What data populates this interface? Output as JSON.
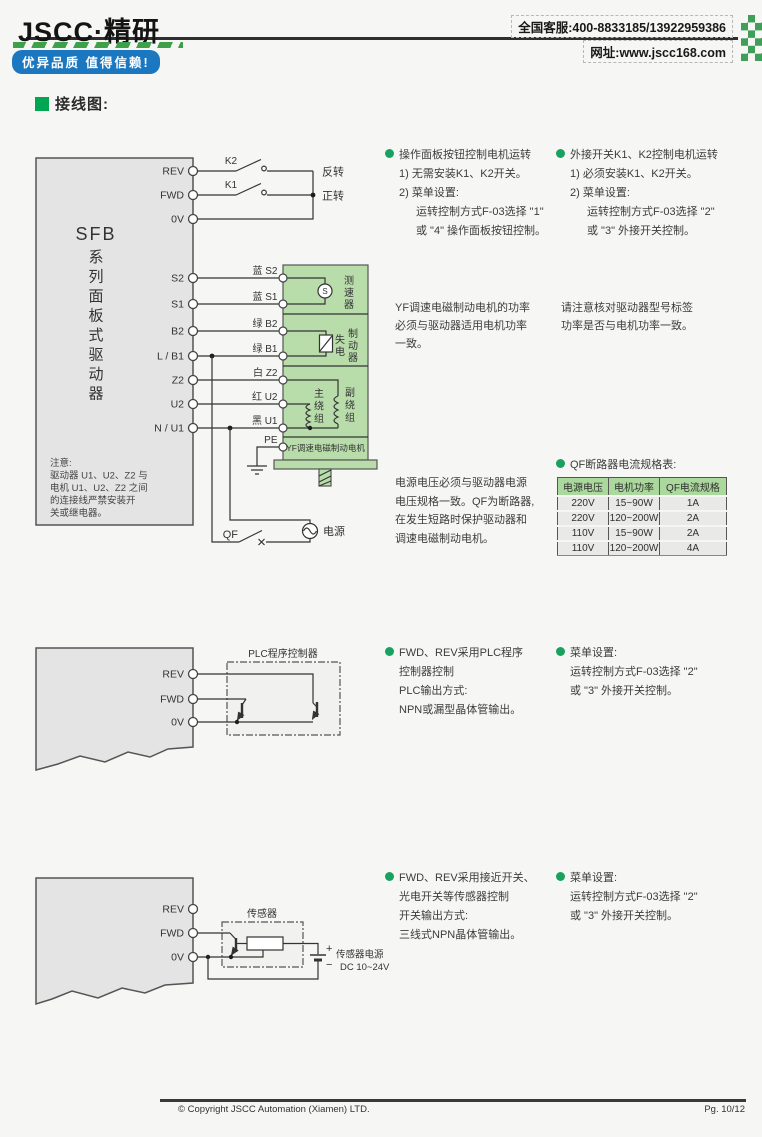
{
  "header": {
    "logo": "JSCC·精研",
    "slogan": "优异品质 值得信赖!",
    "phone": "全国客服:400-8833185/13922959386",
    "website": "网址:www.jscc168.com"
  },
  "section": {
    "title": "接线图:"
  },
  "diagram1": {
    "driver_name": "SFB",
    "driver_chars": [
      "系",
      "列",
      "面",
      "板",
      "式",
      "驱",
      "动",
      "器"
    ],
    "note": [
      "注意:",
      "驱动器 U1、U2、Z2 与",
      "电机 U1、U2、Z2 之间",
      "的连接线严禁安装开",
      "关或继电器。"
    ],
    "terminals": [
      "REV",
      "FWD",
      "0V",
      "S2",
      "S1",
      "B2",
      "L / B1",
      "Z2",
      "U2",
      "N / U1"
    ],
    "k2": "K2",
    "k1": "K1",
    "reverse": "反转",
    "forward": "正转",
    "wires": [
      "蓝 S2",
      "蓝 S1",
      "绿 B2",
      "绿 B1",
      "白 Z2",
      "红 U2",
      "黑 U1"
    ],
    "pe": "PE",
    "tach": [
      "测",
      "速",
      "器"
    ],
    "tach_s": "S",
    "brake_a": [
      "失",
      "电"
    ],
    "brake_b": [
      "制",
      "动",
      "器"
    ],
    "main_w": [
      "主",
      "绕",
      "组"
    ],
    "aux_w": [
      "副",
      "绕",
      "组"
    ],
    "motor_name": "YF调速电磁制动电机",
    "qf": "QF",
    "power": "电源"
  },
  "col1": {
    "b1_title": "操作面板按钮控制电机运转",
    "b1": [
      "1) 无需安装K1、K2开关。",
      "2) 菜单设置:",
      "运转控制方式F-03选择 \"1\"",
      "或 \"4\" 操作面板按钮控制。"
    ],
    "b2_title": "外接开关K1、K2控制电机运转",
    "b2": [
      "1) 必须安装K1、K2开关。",
      "2) 菜单设置:",
      "运转控制方式F-03选择 \"2\"",
      "或 \"3\" 外接开关控制。"
    ],
    "p1": [
      "YF调速电磁制动电机的功率",
      "必须与驱动器适用电机功率",
      "一致。"
    ],
    "p2": [
      "请注意核对驱动器型号标签",
      "功率是否与电机功率一致。"
    ],
    "p3": [
      "电源电压必须与驱动器电源",
      "电压规格一致。QF为断路器,",
      "在发生短路时保护驱动器和",
      "调速电磁制动电机。"
    ]
  },
  "qf_table": {
    "title": "QF断路器电流规格表:",
    "headers": [
      "电源电压",
      "电机功率",
      "QF电流规格"
    ],
    "rows": [
      [
        "220V",
        "15~90W",
        "1A"
      ],
      [
        "220V",
        "120~200W",
        "2A"
      ],
      [
        "110V",
        "15~90W",
        "2A"
      ],
      [
        "110V",
        "120~200W",
        "4A"
      ]
    ]
  },
  "diagram2": {
    "terminals": [
      "REV",
      "FWD",
      "0V"
    ],
    "box_label": "PLC程序控制器",
    "b1_title": "FWD、REV采用PLC程序",
    "b1": [
      "控制器控制",
      "PLC输出方式:",
      "NPN或漏型晶体管输出。"
    ],
    "b2_title": "菜单设置:",
    "b2": [
      "运转控制方式F-03选择 \"2\"",
      "或 \"3\" 外接开关控制。"
    ]
  },
  "diagram3": {
    "terminals": [
      "REV",
      "FWD",
      "0V"
    ],
    "box_label": "传感器",
    "plus": "+",
    "minus": "−",
    "psu": [
      "传感器电源",
      "DC 10~24V"
    ],
    "b1_title": "FWD、REV采用接近开关、",
    "b1": [
      "光电开关等传感器控制",
      "开关输出方式:",
      "三线式NPN晶体管输出。"
    ],
    "b2_title": "菜单设置:",
    "b2": [
      "运转控制方式F-03选择 \"2\"",
      "或 \"3\" 外接开关控制。"
    ]
  },
  "footer": {
    "copyright": "© Copyright JSCC Automation (Xiamen) LTD.",
    "page": "Pg. 10/12"
  }
}
